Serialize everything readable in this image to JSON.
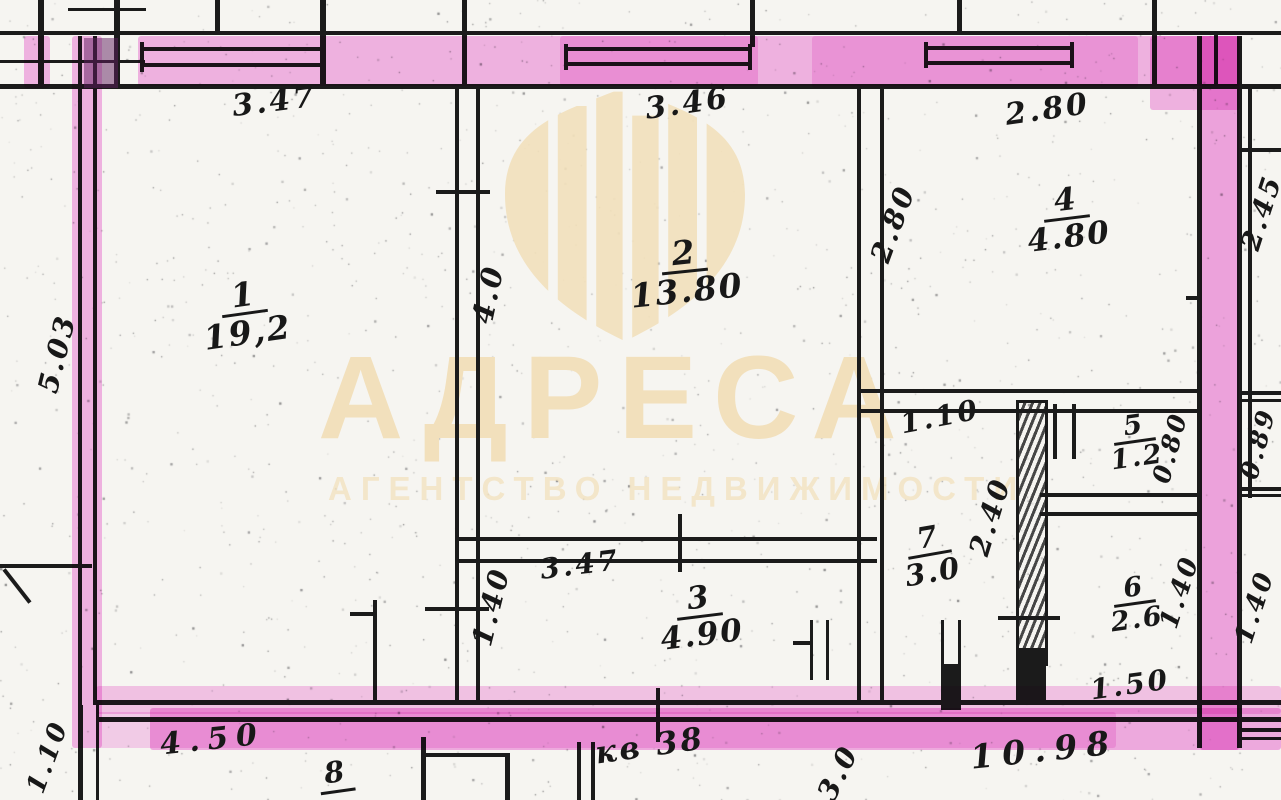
{
  "plan": {
    "apartment_label": "кв 38",
    "outside_room_number": "8",
    "rooms": [
      {
        "number": "1",
        "area": "19,2"
      },
      {
        "number": "2",
        "area": "13.80"
      },
      {
        "number": "3",
        "area": "4.90"
      },
      {
        "number": "4",
        "area": "4.80"
      },
      {
        "number": "5",
        "area": "1.2"
      },
      {
        "number": "6",
        "area": "2.6"
      },
      {
        "number": "7",
        "area": "3.0"
      }
    ],
    "dimensions": {
      "room1_width_top": "3.47",
      "room2_width_top": "3.46",
      "room4_width_top": "2.80",
      "left_wall_height": "5.03",
      "room2_height_left": "4.0",
      "room4_height_left": "2.80",
      "right_top": "2.45",
      "room5_height_right": "0.80",
      "right_middle": "0.89",
      "room4_opening": "1.10",
      "corridor_height_right": "2.40",
      "room3_width_top": "3.47",
      "room3_height_left": "1.40",
      "room6_height_right": "1.40",
      "right_bottom": "1.40",
      "room6_width_bottom": "1.50",
      "bottom_left_width": "4.50",
      "bottom_corner": "1.10",
      "bottom_right_width": "10.98",
      "bottom_center": "3.0"
    }
  },
  "watermark": {
    "brand": "АДРЕСА",
    "subtitle": "АГЕНТСТВО НЕДВИЖИМОСТИ",
    "color": "#f2e0bc"
  },
  "colors": {
    "wall_ink": "#1b1b1b",
    "highlight_pink": "#ef6fd8",
    "paper": "#f6f5f1",
    "watermark_beige": "#f2e0bc"
  }
}
